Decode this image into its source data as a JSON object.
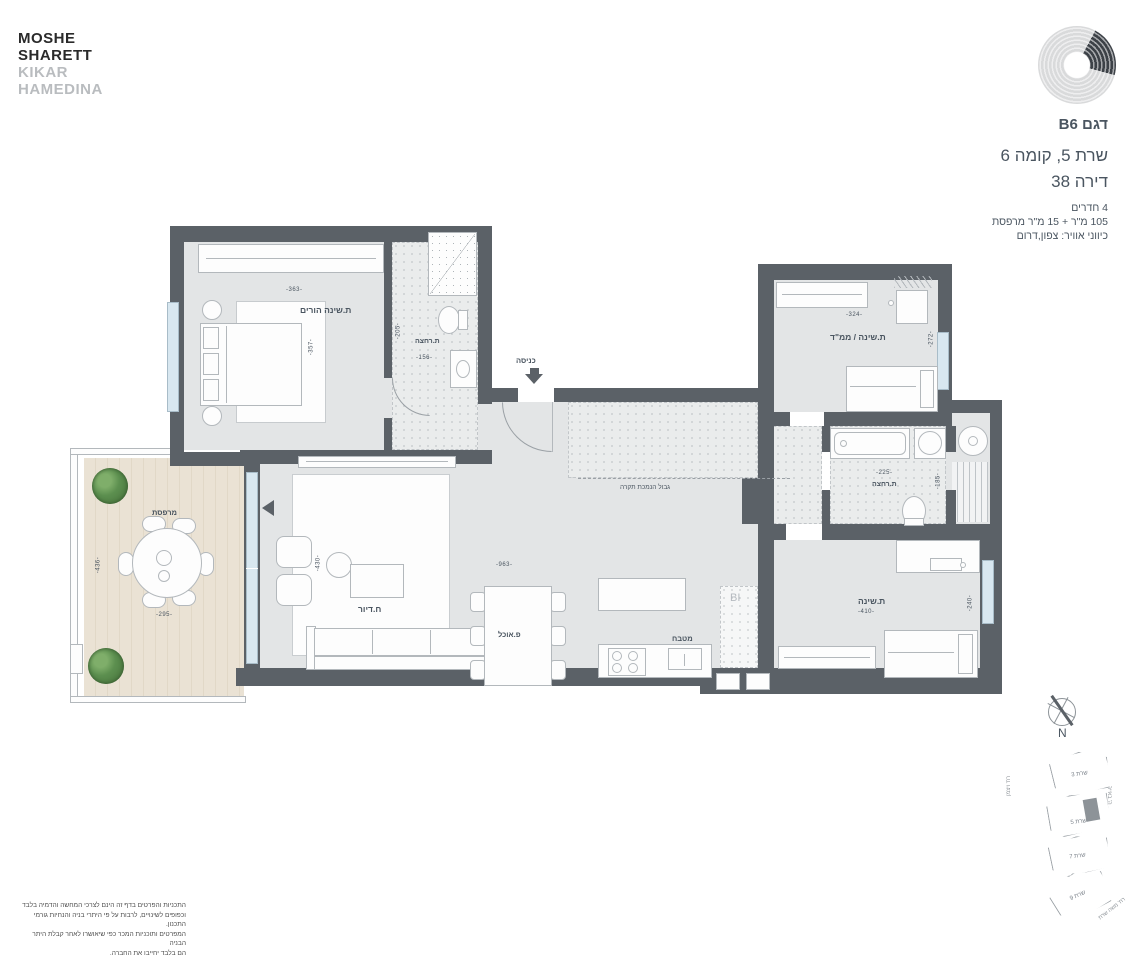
{
  "brand": {
    "line1": "MOSHE",
    "line2": "SHARETT",
    "line3": "KIKAR",
    "line4": "HAMEDINA"
  },
  "header": {
    "model": "דגם B6",
    "building_floor": "שרת 5, קומה 6",
    "apartment": "דירה 38",
    "rooms": "4 חדרים",
    "area": "105 מ\"ר + 15 מ\"ר מרפסת",
    "directions": "כיווני אוויר: צפון,דרום"
  },
  "plan": {
    "master_bedroom": {
      "label": "ת.שינה הורים",
      "width": "-363-",
      "depth": "-357-"
    },
    "bathroom1": {
      "label": "ת.רחצה",
      "width": "-156-",
      "depth": "-205-"
    },
    "entrance": {
      "label": "כניסה"
    },
    "mamad": {
      "label": "ת.שינה / ממ\"ד",
      "width": "-324-",
      "depth": "-272-"
    },
    "bathroom2": {
      "label": "ת.רחצה",
      "width": "-225-",
      "depth": "-185-"
    },
    "bedroom3": {
      "label": "ת.שינה",
      "width": "-410-",
      "depth": "-240-"
    },
    "living": {
      "label": "ח.דיור",
      "depth": "-430-"
    },
    "living_dining_width": "-963-",
    "dining": {
      "label": "פ.אוכל"
    },
    "kitchen": {
      "label": "מטבח"
    },
    "balcony": {
      "label": "מרפסת",
      "width": "-295-",
      "depth": "-436-"
    },
    "shaft": {
      "label": "BI"
    },
    "ceiling_note": "גבול הנמכת תקרה"
  },
  "compass": {
    "north": "N"
  },
  "siteplan": {
    "buildings": [
      {
        "label": "שרת 3"
      },
      {
        "label": "שרת 5"
      },
      {
        "label": "שרת 7"
      },
      {
        "label": "שרת 9"
      }
    ],
    "street_left": "רח' ויצמן",
    "street_right": "ה' באייר",
    "street_bottom": "רח' משה שרת"
  },
  "disclaimer": {
    "line1": "התכניות והפרטים בדף זה הינם לצרכי המחשה והדמיה בלבד",
    "line2": "וכפופים לשינויים, לרבות על פי היתרי בניה והנחיות גורמי התכנון.",
    "line3": "המפרטים ותוכניות המכר כפי שיאושרו לאחר קבלת היתר הבניה",
    "line4": "הם בלבד יחייבו את החברה."
  },
  "colors": {
    "wall": "#5b6167",
    "text": "#4a5560",
    "brand_muted": "#b9bcbf",
    "glass": "#d8e7f0"
  }
}
